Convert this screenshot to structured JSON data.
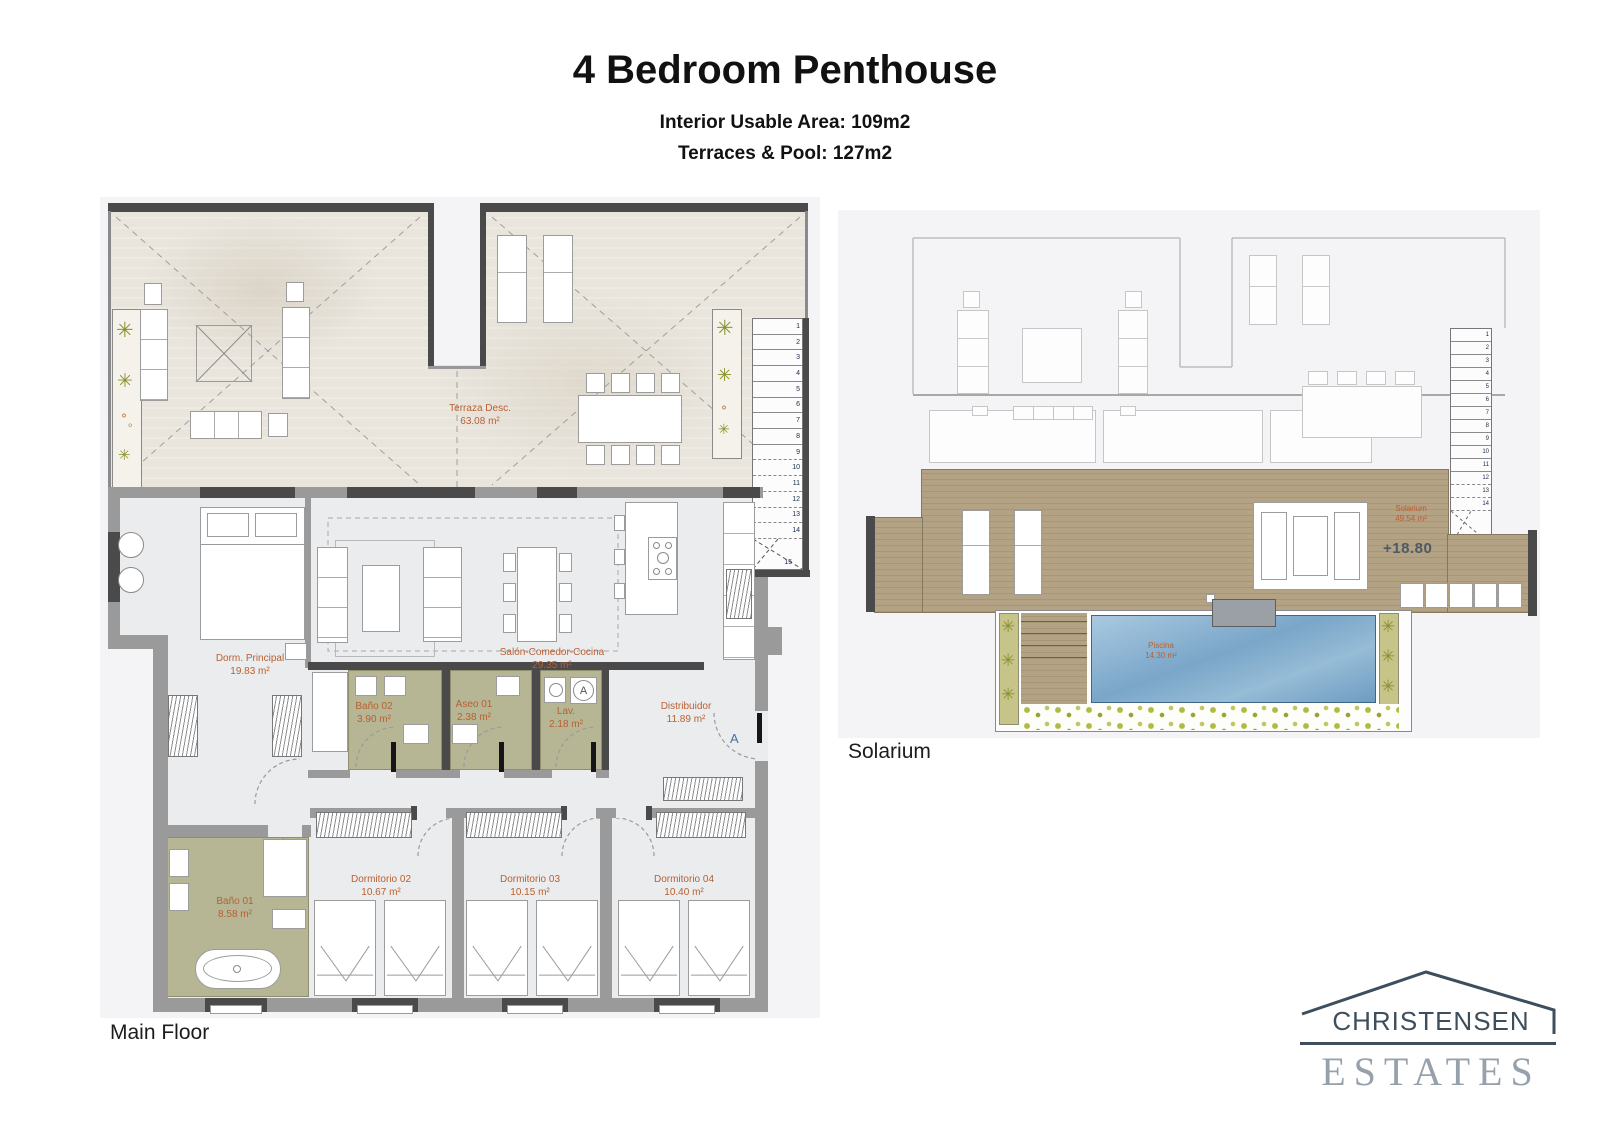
{
  "header": {
    "title": "4 Bedroom Penthouse",
    "subtitle_line1": "Interior Usable Area: 109m2",
    "subtitle_line2": "Terraces & Pool: 127m2"
  },
  "main_floor": {
    "caption": "Main Floor",
    "rooms": {
      "terraza": {
        "name": "Terraza Desc.",
        "area": "63.08 m²"
      },
      "dorm_principal": {
        "name": "Dorm. Principal",
        "area": "19.83 m²"
      },
      "salon": {
        "name": "Salón-Comedor-Cocina",
        "area": "29.35 m²"
      },
      "bano02": {
        "name": "Baño 02",
        "area": "3.90 m²"
      },
      "aseo01": {
        "name": "Aseo 01",
        "area": "2.38 m²"
      },
      "lav": {
        "name": "Lav.",
        "area": "2.18 m²"
      },
      "distribuidor": {
        "name": "Distribuidor",
        "area": "11.89 m²"
      },
      "bano01": {
        "name": "Baño 01",
        "area": "8.58 m²"
      },
      "dorm02": {
        "name": "Dormitorio 02",
        "area": "10.67 m²"
      },
      "dorm03": {
        "name": "Dormitorio 03",
        "area": "10.15 m²"
      },
      "dorm04": {
        "name": "Dormitorio 04",
        "area": "10.40 m²"
      }
    },
    "stairs": [
      "1",
      "2",
      "3",
      "4",
      "5",
      "6",
      "7",
      "8",
      "9",
      "10",
      "11",
      "12",
      "13",
      "14",
      "15"
    ],
    "section_marker": "A",
    "washer_letter": "A"
  },
  "solarium_floor": {
    "caption": "Solarium",
    "rooms": {
      "solarium": {
        "name": "Solarium",
        "area": "49.54 m²"
      },
      "piscina": {
        "name": "Piscina",
        "area": "14.30 m²"
      }
    },
    "level_marker": "+18.80",
    "stairs": [
      "1",
      "2",
      "3",
      "4",
      "5",
      "6",
      "7",
      "8",
      "9",
      "10",
      "11",
      "12",
      "13",
      "14"
    ],
    "stairs_turn": "15",
    "stairs_extra": "16"
  },
  "logo": {
    "name_line": "CHRISTENSEN",
    "type_line": "ESTATES"
  },
  "colors": {
    "label_orange": "#b95f30",
    "wall_gray": "#9a9a9a",
    "wall_dark": "#4a4a4a",
    "olive_floor": "#b7b694",
    "deck_tan": "#b3a284",
    "pool_blue": "#7ba3c6",
    "logo_navy": "#3e4e5c",
    "logo_gray": "#97a1ac"
  }
}
